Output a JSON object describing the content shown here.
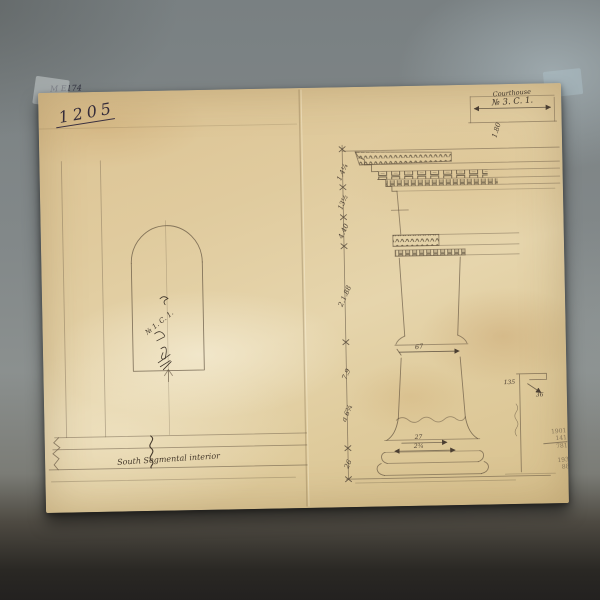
{
  "photo": {
    "archive_code": "M E174"
  },
  "paper": {
    "inventory_number": "1205",
    "title_block": {
      "line1": "Courthouse",
      "line2": "№ 3. C. 1."
    },
    "top_dim": "1.80"
  },
  "order": {
    "dims": [
      "1.4¼",
      "13½",
      "4.40",
      "2.1.88",
      "7.9",
      "a 6¾",
      "26"
    ],
    "neck_width": "67",
    "base_dim_upper": "27",
    "base_dim_lower": "2¾"
  },
  "niche": {
    "annotation": "№ 1. C. 1.",
    "caption": "South Segmental interior"
  },
  "detail": {
    "dim_a": "135",
    "dim_b": "36"
  },
  "pencil_calc": {
    "rows": [
      "1901",
      "141",
      "781",
      "193",
      "88"
    ]
  }
}
